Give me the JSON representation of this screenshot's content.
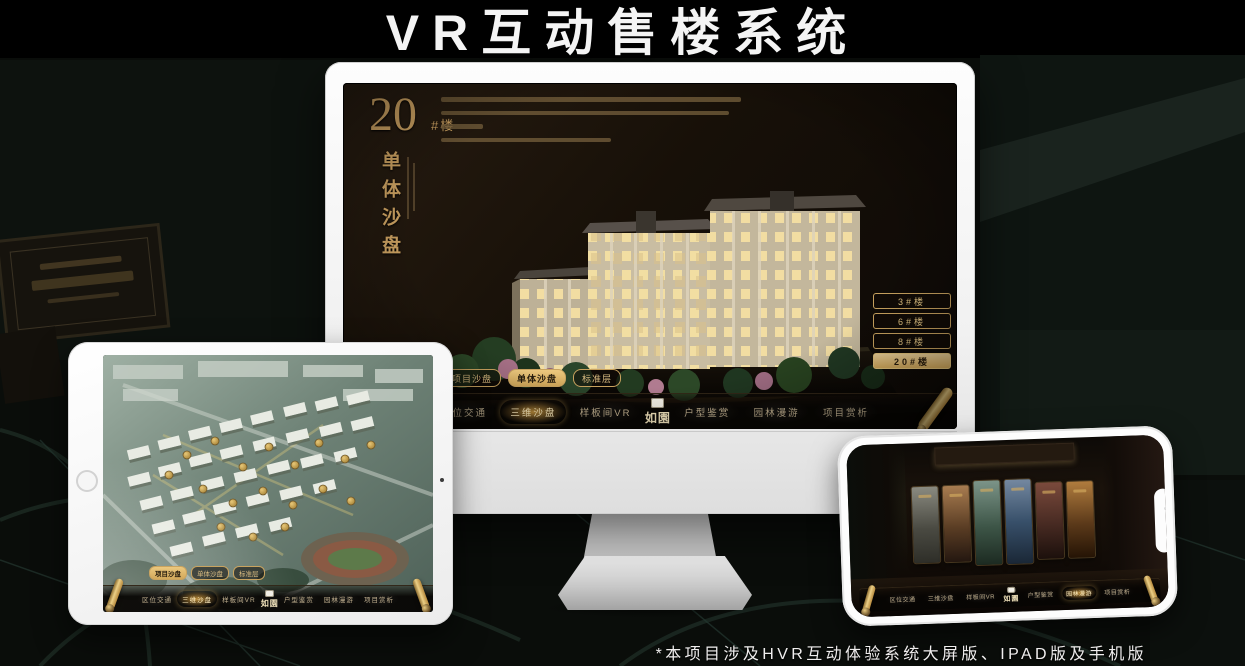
{
  "page": {
    "title": "VR互动售楼系统",
    "footnote": "*本项目涉及HVR互动体验系统大屏版、IPAD版及手机版"
  },
  "brand": {
    "logo_text": "如園",
    "gold_accent": "#c9a35f",
    "gold_fill": "#d9ae5e"
  },
  "desktop": {
    "headline_number": "20",
    "headline_unit": "#楼",
    "headline_vertical": "单体沙盘",
    "floor_buttons": [
      {
        "label": "3#楼",
        "active": false
      },
      {
        "label": "6#楼",
        "active": false
      },
      {
        "label": "8#楼",
        "active": false
      },
      {
        "label": "20#楼",
        "active": true
      }
    ],
    "sub_tabs": [
      {
        "label": "项目沙盘",
        "active": false
      },
      {
        "label": "单体沙盘",
        "active": true
      },
      {
        "label": "标准层",
        "active": false
      }
    ],
    "nav_left": [
      {
        "label": "区位交通",
        "active": false
      },
      {
        "label": "三维沙盘",
        "active": true
      },
      {
        "label": "样板间VR",
        "active": false
      }
    ],
    "nav_right": [
      {
        "label": "户型鉴赏",
        "active": false
      },
      {
        "label": "园林漫游",
        "active": false
      },
      {
        "label": "项目赏析",
        "active": false
      }
    ]
  },
  "tablet": {
    "sub_tabs": [
      {
        "label": "项目沙盘",
        "active": true
      },
      {
        "label": "单体沙盘",
        "active": false
      },
      {
        "label": "标准层",
        "active": false
      }
    ],
    "nav_left": [
      {
        "label": "区位交通",
        "active": false
      },
      {
        "label": "三维沙盘",
        "active": true
      },
      {
        "label": "样板间VR",
        "active": false
      }
    ],
    "nav_right": [
      {
        "label": "户型鉴赏",
        "active": false
      },
      {
        "label": "园林漫游",
        "active": false
      },
      {
        "label": "项目赏析",
        "active": false
      }
    ]
  },
  "phone": {
    "nav_left": [
      {
        "label": "区位交通",
        "active": false
      },
      {
        "label": "三维沙盘",
        "active": false
      },
      {
        "label": "样板间VR",
        "active": false
      }
    ],
    "nav_right": [
      {
        "label": "户型鉴赏",
        "active": false
      },
      {
        "label": "园林漫游",
        "active": true
      },
      {
        "label": "项目赏析",
        "active": false
      }
    ]
  }
}
